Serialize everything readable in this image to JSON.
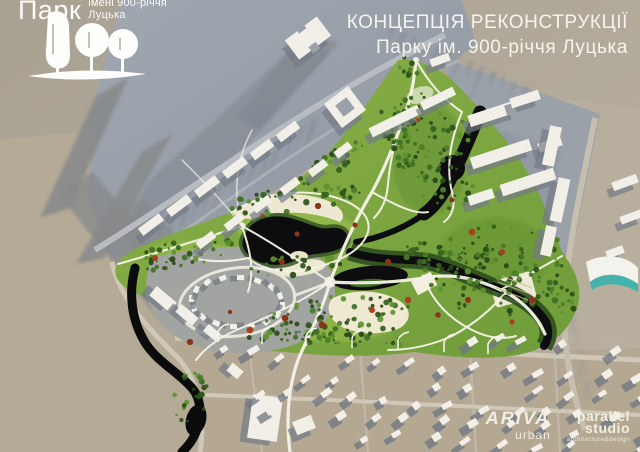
{
  "header": {
    "logo": {
      "name": "Парк",
      "sub1": "імені 900-річчя",
      "sub2": "Луцька"
    },
    "title": {
      "line1": "КОНЦЕПЦІЯ РЕКОНСТРУКЦІЇ",
      "line2": "Парку ім. 900-річчя Луцька"
    }
  },
  "footer": {
    "ariva": {
      "name": "ARiVA",
      "tag": "urban"
    },
    "parallel_studio": {
      "name1": "parallel",
      "name2": "studio",
      "tag": "architecture&design"
    }
  },
  "map": {
    "description": "Aerial 3D masterplan rendering of the reconstruction concept for the 900th Anniversary of Lutsk Park: central green park with dark lake and winding river, white path network, surrounding grey city blocks and beige low-rise districts",
    "palette": {
      "background": "#ada595",
      "background2": "#bbb2a3",
      "beige": "#b5aa96",
      "city_gray": "#9aa1ab",
      "city_gray_dark": "#8b93a0",
      "pocket_gray": "#a2a4a1",
      "long_shadow": "#87898b",
      "park_green": "#7da33c",
      "park_light": "#a6c754",
      "park_dark": "#5d8a2e",
      "tree_red": "#a8401f",
      "water": "#0d0d0f",
      "bank_green": "#2e4d1e",
      "path_white": "#f6f3e8",
      "cream": "#eee8d2",
      "building_white": "#f1efe7",
      "building_shadow": "#747b86",
      "road_gray": "#b8bcc2",
      "road_tan": "#cfc8b9",
      "teal": "#38b2ad",
      "tree_greens": [
        "#2c5219",
        "#33611e",
        "#3f7024",
        "#274916",
        "#4b7d28",
        "#5e9230"
      ]
    }
  }
}
